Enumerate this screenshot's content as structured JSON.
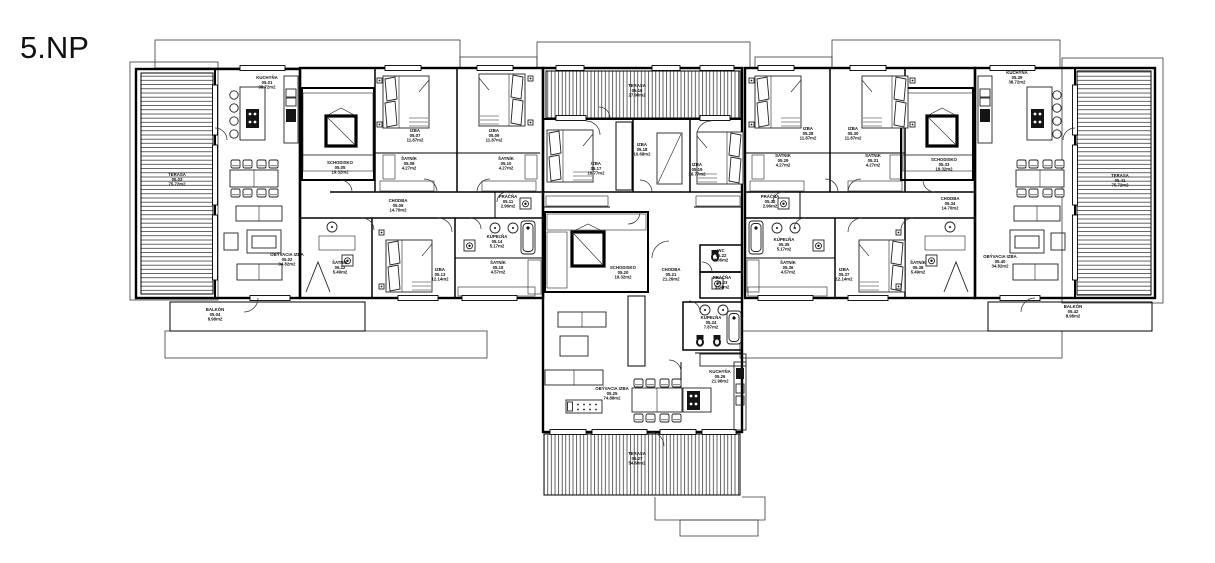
{
  "title": "5.NP",
  "drawing": {
    "type": "architectural floor plan",
    "floor_label": "5.NP"
  },
  "rooms": [
    {
      "name": "KUCHYŇA",
      "num": "05.01",
      "area": "38.72m2",
      "x": 267,
      "y": 79
    },
    {
      "name": "OBÝVACIA IZBA",
      "num": "05.02",
      "area": "34.82m2",
      "x": 287,
      "y": 256
    },
    {
      "name": "TERASA",
      "num": "05.03",
      "area": "75.72m2",
      "x": 177,
      "y": 176
    },
    {
      "name": "BALKÓN",
      "num": "05.04",
      "area": "8.98m2",
      "x": 215,
      "y": 311
    },
    {
      "name": "SCHODISKO",
      "num": "05.05",
      "area": "19.32m2",
      "x": 340,
      "y": 164
    },
    {
      "name": "CHODBA",
      "num": "05.06",
      "area": "14.70m2",
      "x": 398,
      "y": 202
    },
    {
      "name": "IZBA",
      "num": "05.07",
      "area": "11.87m2",
      "x": 415,
      "y": 132
    },
    {
      "name": "ŠATNÍK",
      "num": "05.08",
      "area": "4.27m2",
      "x": 409,
      "y": 160
    },
    {
      "name": "IZBA",
      "num": "05.09",
      "area": "11.87m2",
      "x": 494,
      "y": 132
    },
    {
      "name": "ŠATNÍK",
      "num": "05.10",
      "area": "4.27m2",
      "x": 506,
      "y": 160
    },
    {
      "name": "PRÁČŇA",
      "num": "05.11",
      "area": "2.96m2",
      "x": 508,
      "y": 198
    },
    {
      "name": "ŠATNÍK",
      "num": "05.12",
      "area": "5.49m2",
      "x": 340,
      "y": 264
    },
    {
      "name": "IZBA",
      "num": "05.13",
      "area": "12.14m2",
      "x": 440,
      "y": 271
    },
    {
      "name": "KÚPEĽŇA",
      "num": "05.14",
      "area": "5.17m2",
      "x": 497,
      "y": 238
    },
    {
      "name": "ŠATNÍK",
      "num": "05.15",
      "area": "4.57m2",
      "x": 498,
      "y": 264
    },
    {
      "name": "TERASA",
      "num": "05.16",
      "area": "27.90m2",
      "x": 637,
      "y": 87
    },
    {
      "name": "IZBA",
      "num": "05.17",
      "area": "16.77m2",
      "x": 596,
      "y": 165
    },
    {
      "name": "IZBA",
      "num": "05.18",
      "area": "10.68m2",
      "x": 642,
      "y": 146
    },
    {
      "name": "IZBA",
      "num": "05.19",
      "area": "16.77m2",
      "x": 697,
      "y": 166
    },
    {
      "name": "SCHODISKO",
      "num": "05.20",
      "area": "19.32m2",
      "x": 623,
      "y": 269
    },
    {
      "name": "CHODBA",
      "num": "05.21",
      "area": "21.26m2",
      "x": 671,
      "y": 271
    },
    {
      "name": "WC",
      "num": "05.22",
      "area": "2.06m2",
      "x": 721,
      "y": 252
    },
    {
      "name": "PRÁČŇA",
      "num": "05.23",
      "area": "3.04m2",
      "x": 722,
      "y": 279
    },
    {
      "name": "KÚPEĽŇA",
      "num": "05.24",
      "area": "7.87m2",
      "x": 711,
      "y": 319
    },
    {
      "name": "OBÝVACIA IZBA",
      "num": "05.25",
      "area": "74.88m2",
      "x": 612,
      "y": 390
    },
    {
      "name": "KUCHYŇA",
      "num": "05.26",
      "area": "21.96m2",
      "x": 720,
      "y": 373
    },
    {
      "name": "TERASA",
      "num": "05.27",
      "area": "54.60m2",
      "x": 637,
      "y": 455
    },
    {
      "name": "IZBA",
      "num": "05.28",
      "area": "11.87m2",
      "x": 808,
      "y": 130
    },
    {
      "name": "ŠATNÍK",
      "num": "05.29",
      "area": "4.27m2",
      "x": 783,
      "y": 157
    },
    {
      "name": "IZBA",
      "num": "05.30",
      "area": "11.87m2",
      "x": 853,
      "y": 130
    },
    {
      "name": "ŠATNÍK",
      "num": "05.31",
      "area": "4.27m2",
      "x": 873,
      "y": 157
    },
    {
      "name": "PRÁČŇA",
      "num": "05.32",
      "area": "2.96m2",
      "x": 770,
      "y": 198
    },
    {
      "name": "SCHODISKO",
      "num": "05.33",
      "area": "19.32m2",
      "x": 944,
      "y": 161
    },
    {
      "name": "CHODBA",
      "num": "05.34",
      "area": "14.70m2",
      "x": 950,
      "y": 200
    },
    {
      "name": "KÚPEĽŇA",
      "num": "05.35",
      "area": "5.17m2",
      "x": 784,
      "y": 241
    },
    {
      "name": "ŠATNÍK",
      "num": "05.36",
      "area": "4.57m2",
      "x": 788,
      "y": 264
    },
    {
      "name": "IZBA",
      "num": "05.37",
      "area": "12.14m2",
      "x": 844,
      "y": 271
    },
    {
      "name": "ŠATNÍK",
      "num": "05.38",
      "area": "5.49m2",
      "x": 918,
      "y": 264
    },
    {
      "name": "KUCHYŇA",
      "num": "05.39",
      "area": "38.72m2",
      "x": 1017,
      "y": 74
    },
    {
      "name": "OBÝVACIA IZBA",
      "num": "05.40",
      "area": "34.82m2",
      "x": 1000,
      "y": 258
    },
    {
      "name": "TERASA",
      "num": "05.41",
      "area": "75.72m2",
      "x": 1120,
      "y": 177
    },
    {
      "name": "BALKÓN",
      "num": "05.42",
      "area": "8.98m2",
      "x": 1073,
      "y": 308
    }
  ]
}
